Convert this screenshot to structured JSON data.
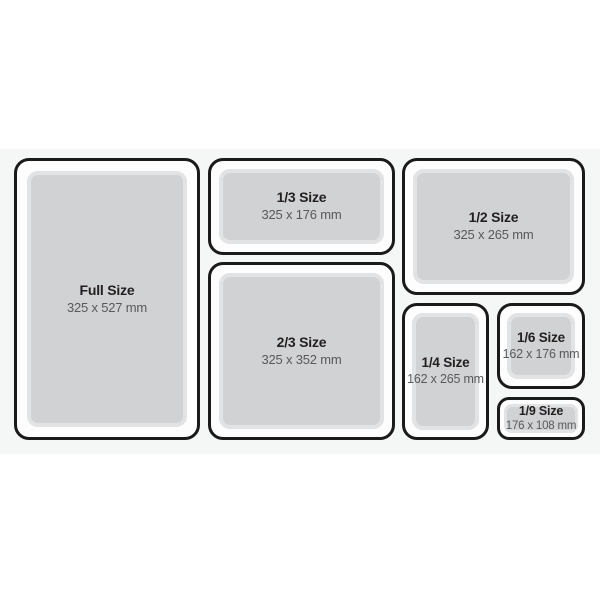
{
  "colors": {
    "page_background": "#ffffff",
    "band_background": "#f5f6f6",
    "panel_border": "#1a1a1a",
    "panel_fill": "#fdfdfd",
    "tray_fill": "#d0d2d3",
    "tray_rim": "#e2e3e4",
    "title_text": "#231f20",
    "dims_text": "#58595b"
  },
  "panels": [
    {
      "id": "full-size",
      "label": "Full Size",
      "dimensions": "325 x 527 mm"
    },
    {
      "id": "one-third-size",
      "label": "1/3 Size",
      "dimensions": "325 x 176 mm"
    },
    {
      "id": "one-half-size",
      "label": "1/2 Size",
      "dimensions": "325 x 265 mm"
    },
    {
      "id": "two-thirds-size",
      "label": "2/3 Size",
      "dimensions": "325 x 352 mm"
    },
    {
      "id": "one-quarter-size",
      "label": "1/4 Size",
      "dimensions": "162 x 265 mm"
    },
    {
      "id": "one-sixth-size",
      "label": "1/6 Size",
      "dimensions": "162 x 176 mm"
    },
    {
      "id": "one-ninth-size",
      "label": "1/9 Size",
      "dimensions": "176 x 108 mm"
    }
  ]
}
